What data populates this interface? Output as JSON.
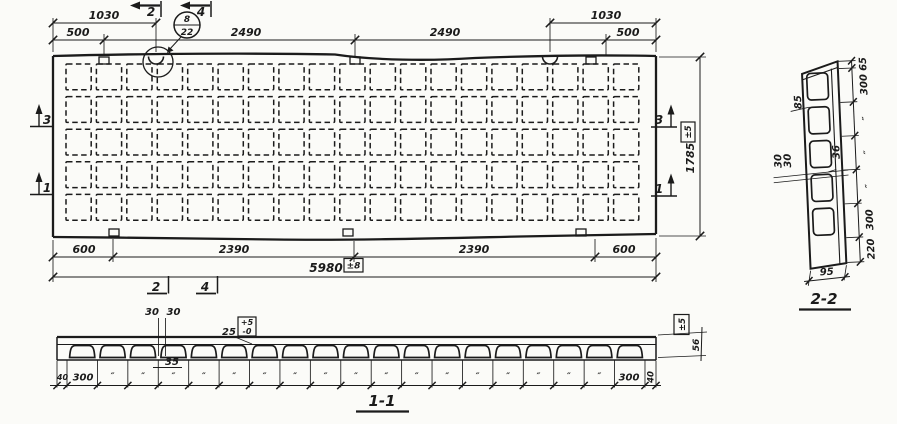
{
  "drawing": {
    "ink_color": "#1b1b1b",
    "paper_color": "#fbfbf8",
    "plan": {
      "grid": {
        "rows": 5,
        "cols": 19
      },
      "dims_top": {
        "d1030_left": "1030",
        "d500_left": "500",
        "d2490_a": "2490",
        "d2490_b": "2490",
        "d1030_right": "1030",
        "d500_right": "500"
      },
      "dims_bottom": {
        "d600_left": "600",
        "d2390_a": "2390",
        "d2390_b": "2390",
        "d600_right": "600",
        "total": "5980",
        "total_tol": "±8"
      },
      "dims_right": {
        "height": "1785",
        "tol": "±5"
      },
      "section_marks": {
        "top_2": "2",
        "top_4": "4",
        "bottom_2": "2",
        "bottom_4": "4",
        "left_3": "3",
        "left_1": "1",
        "right_3": "3",
        "right_1": "1"
      },
      "detail_callout": {
        "top": "8",
        "bottom": "22"
      }
    },
    "section22": {
      "title": "2-2",
      "dims_right": [
        "65",
        "300",
        "″",
        "″",
        "″",
        "300",
        "220"
      ],
      "dim_width": "95",
      "label_85": "85",
      "label_30a": "30",
      "label_30b": "30",
      "label_36": "36",
      "cells": 5
    },
    "section11": {
      "title": "1-1",
      "cells": 19,
      "ditto": "″",
      "left_40": "40",
      "left_300": "300",
      "right_300": "300",
      "right_40": "40",
      "label_30a": "30",
      "label_30b": "30",
      "label_35": "35",
      "label_25": "25",
      "flange_tol_plus": "+5",
      "flange_tol_minus": "-0",
      "thickness": "56",
      "thickness_tol": "±5"
    }
  }
}
